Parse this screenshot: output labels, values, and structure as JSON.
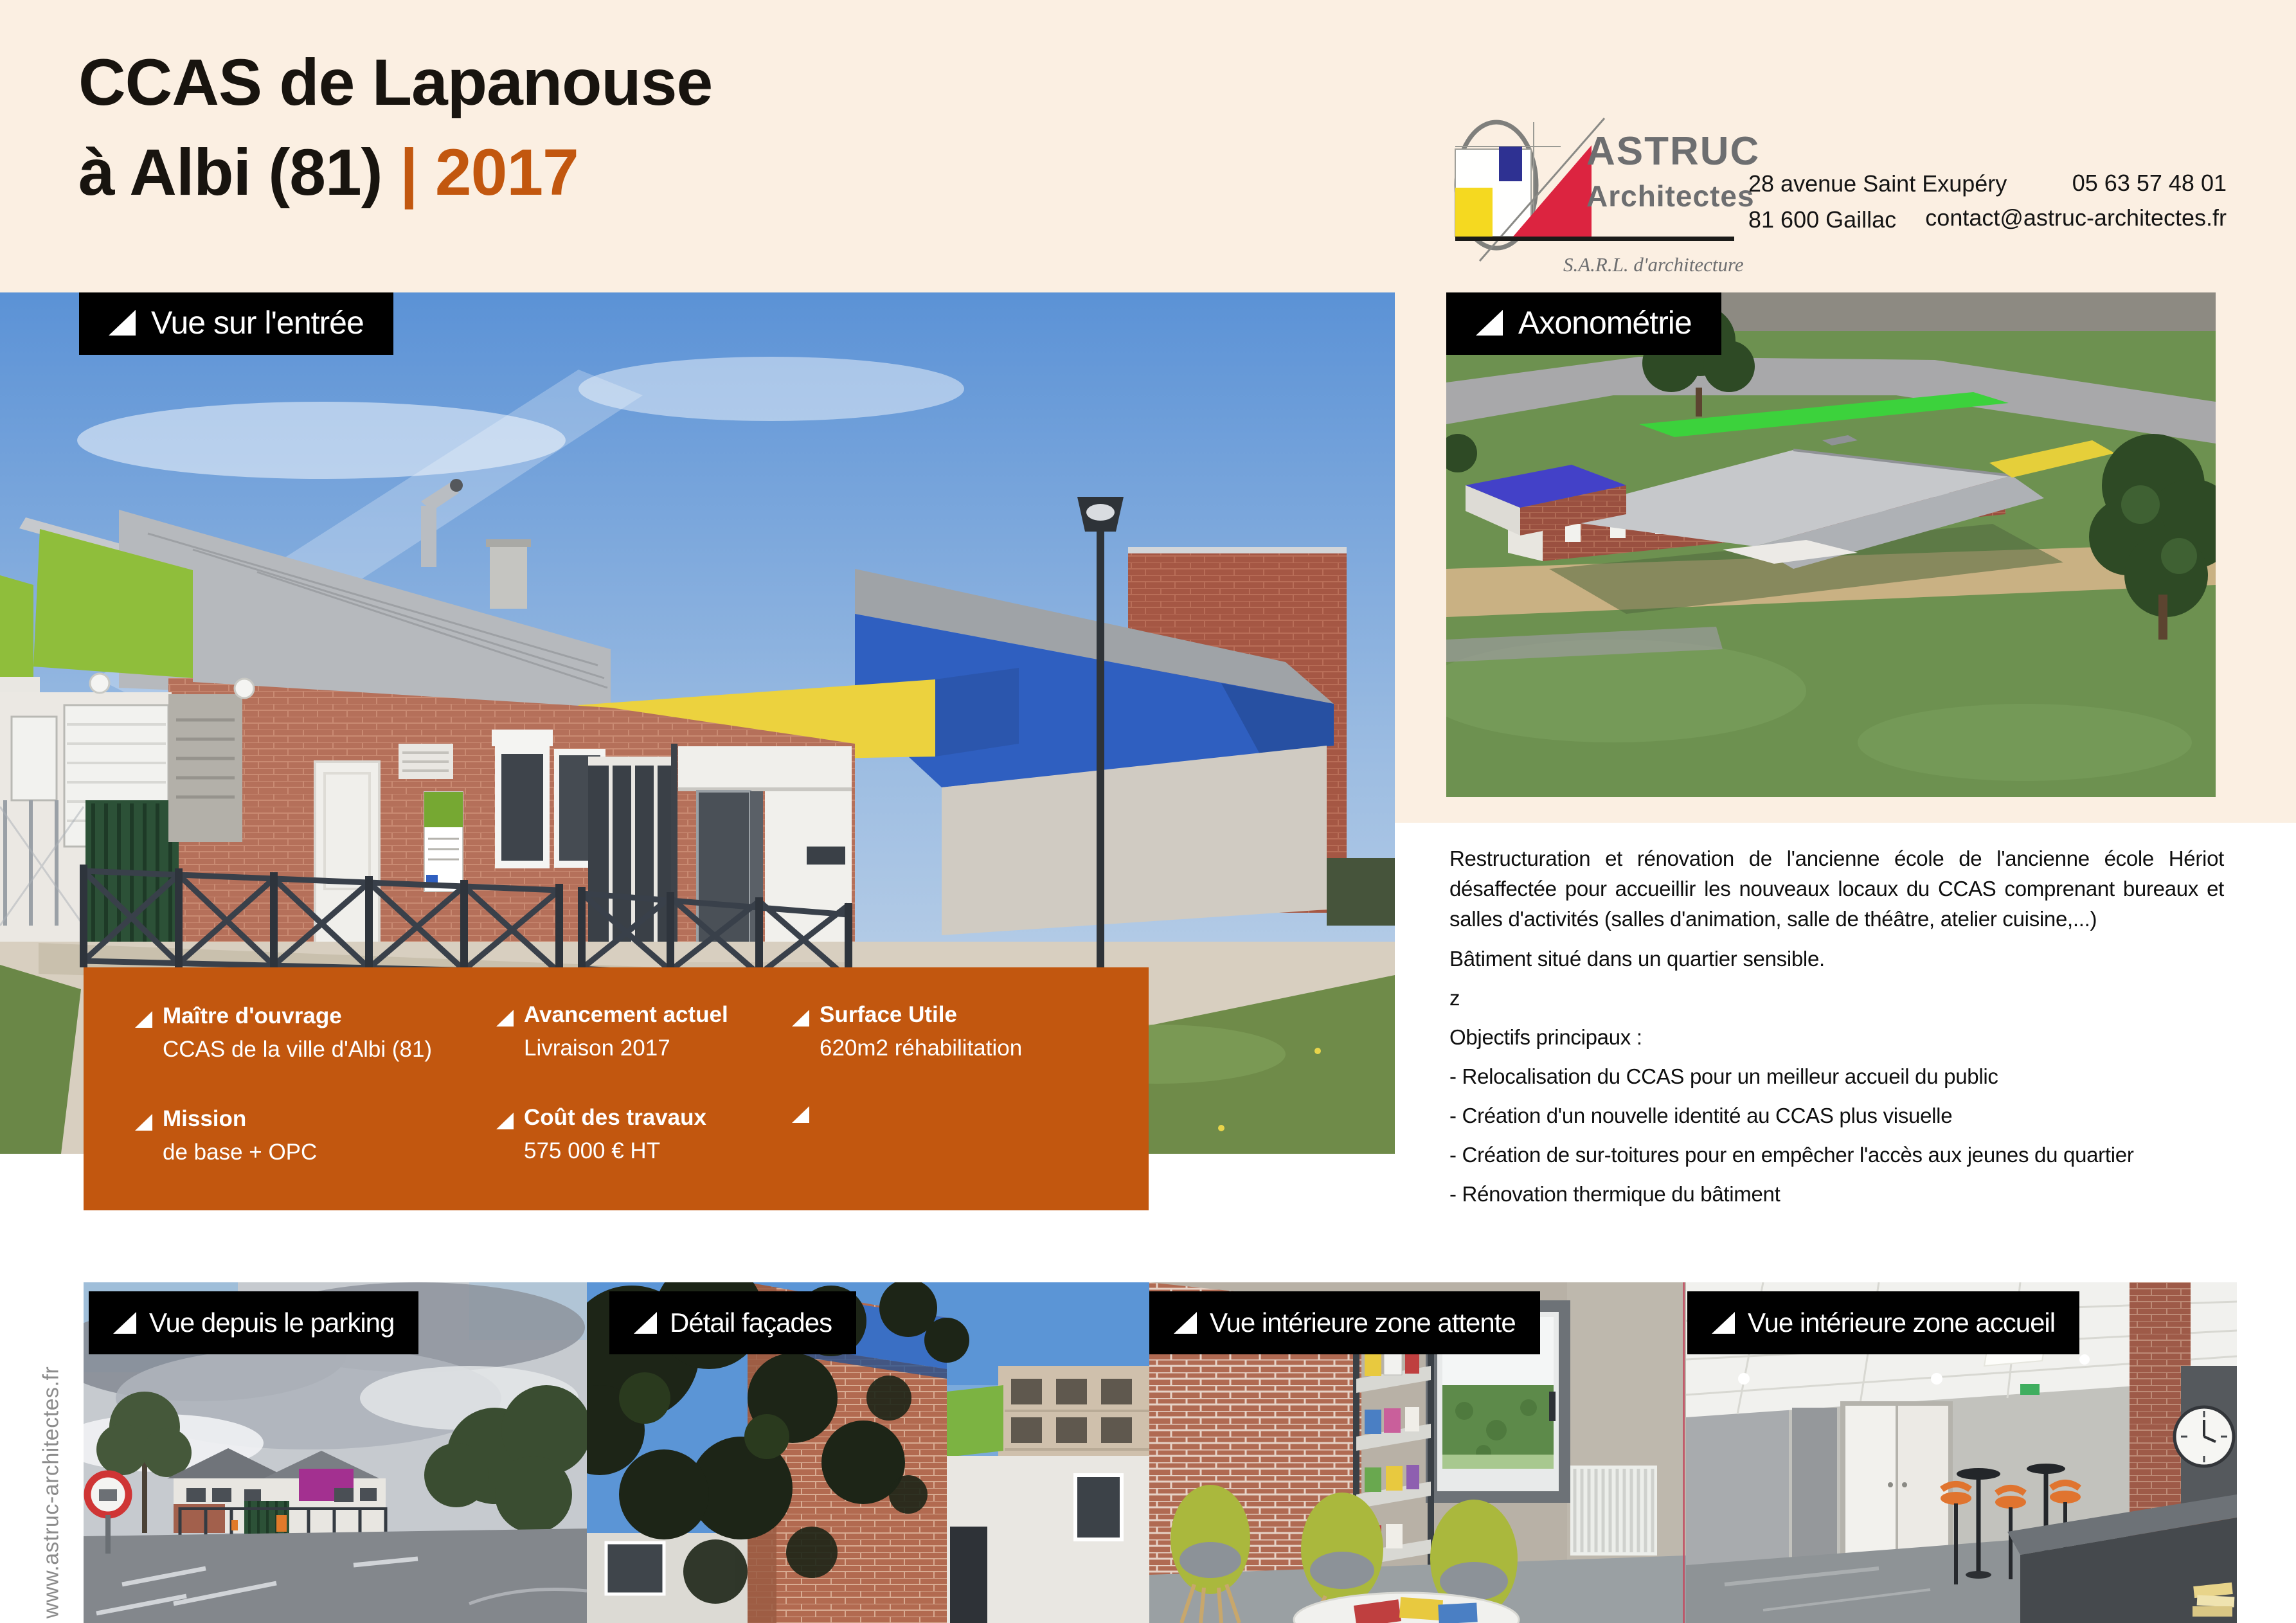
{
  "header": {
    "title": {
      "line1": "CCAS de Lapanouse",
      "line2_black": "à Albi (81) ",
      "line2_accent": "| 2017"
    }
  },
  "logo": {
    "name_line1": "ASTRUC",
    "name_line2": "Architectes",
    "tagline": "S.A.R.L. d'architecture"
  },
  "contact": {
    "address_line1": "28 avenue Saint Exupéry",
    "address_line2": "81 600 Gaillac",
    "phone": "05 63 57 48 01",
    "email": "contact@astruc-architectes.fr"
  },
  "photos": {
    "main": {
      "label": "Vue sur l'entrée"
    },
    "axo": {
      "label": "Axonométrie"
    },
    "bottom": [
      {
        "label": "Vue depuis le parking"
      },
      {
        "label": "Détail façades"
      },
      {
        "label": "Vue intérieure zone attente"
      },
      {
        "label": "Vue intérieure zone accueil"
      }
    ]
  },
  "project_info": {
    "items": [
      {
        "label": "Maître d'ouvrage",
        "value": "CCAS de la ville d'Albi (81)"
      },
      {
        "label": "Avancement actuel",
        "value": "Livraison 2017"
      },
      {
        "label": "Surface Utile",
        "value": "620m2 réhabilitation"
      },
      {
        "label": "Mission",
        "value": "de base + OPC"
      },
      {
        "label": "Coût des travaux",
        "value": "575 000 € HT"
      },
      {
        "label": "",
        "value": ""
      }
    ]
  },
  "description": {
    "paragraph": "Restructuration et rénovation de l'ancienne école de l'ancienne école Hériot désaffectée pour accueillir les nouveaux locaux du CCAS comprenant bureaux et salles d'activités (salles d'animation, salle de théâtre, atelier cuisine,...)",
    "note": "Bâtiment situé dans un quartier sensible.",
    "stray": "z",
    "objectives_title": "Objectifs principaux :",
    "objectives": [
      " - Relocalisation du CCAS pour un meilleur accueil du public",
      "- Création d'un nouvelle identité au CCAS plus visuelle",
      "- Création de sur-toitures pour en empêcher l'accès aux jeunes du quartier",
      "- Rénovation thermique du bâtiment"
    ]
  },
  "footer": {
    "website": "www.astruc-architectes.fr"
  },
  "colors": {
    "accent_orange": "#C2570F",
    "background_cream": "#FBEFE2",
    "label_background": "#000000",
    "label_text": "#FFFFFF",
    "logo_gray": "#6D6E70",
    "website_gray": "#8C8C8C"
  }
}
